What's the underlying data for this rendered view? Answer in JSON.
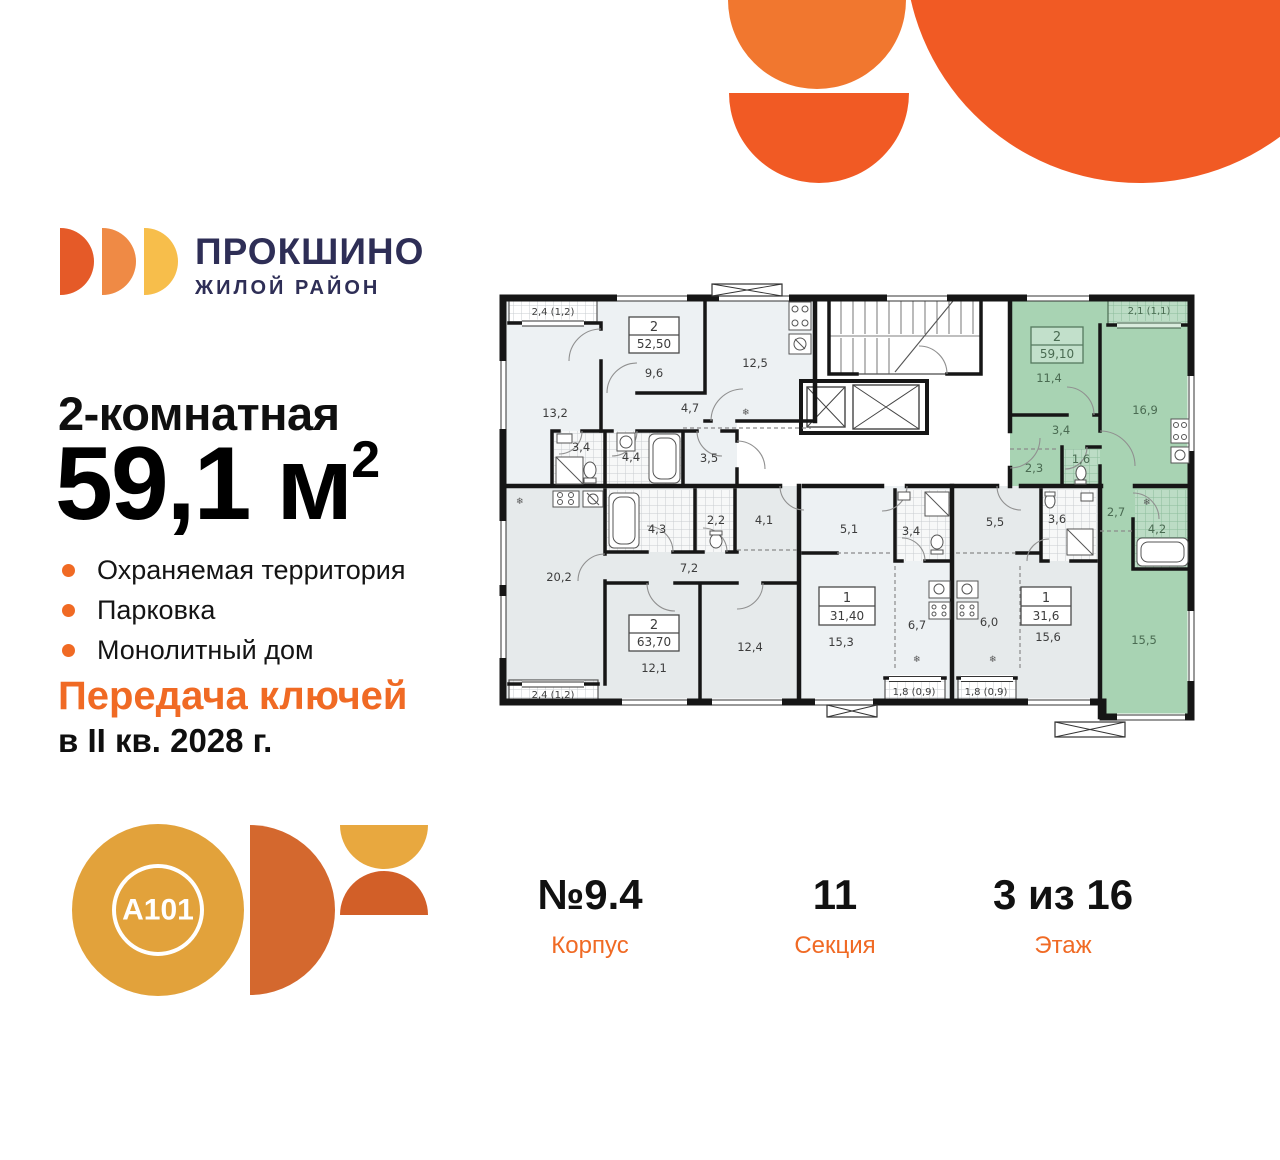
{
  "brand": {
    "name": "ПРОКШИНО",
    "subtitle": "ЖИЛОЙ РАЙОН"
  },
  "offer": {
    "type": "2-комнатная",
    "area_value": "59,1 м",
    "area_sup": "2",
    "features": [
      "Охраняемая территория",
      "Парковка",
      "Монолитный дом"
    ],
    "handover_title": "Передача ключей",
    "handover_date": "в II кв. 2028 г."
  },
  "developer": {
    "logo_text": "A101"
  },
  "meta": {
    "building": {
      "value": "№9.4",
      "label": "Корпус"
    },
    "section": {
      "value": "11",
      "label": "Секция"
    },
    "floor": {
      "value": "3 из 16",
      "label": "Этаж"
    }
  },
  "plan": {
    "a52": {
      "num": "2",
      "area": "52,50",
      "balcony": "2,4 (1,2)",
      "r1": "13,2",
      "r2": "9,6",
      "r3": "12,5",
      "r4": "4,7",
      "r5": "3,4",
      "r6": "4,4",
      "r7": "3,5"
    },
    "a59": {
      "num": "2",
      "area": "59,10",
      "balcony": "2,1 (1,1)",
      "r1": "11,4",
      "r2": "16,9",
      "r3": "3,4",
      "r4": "2,3",
      "r5": "1,6",
      "r6": "2,7",
      "r7": "4,2",
      "r8": "15,5"
    },
    "a63": {
      "num": "2",
      "area": "63,70",
      "balcony": "2,4 (1,2)",
      "r1": "20,2",
      "r2": "4,3",
      "r3": "2,2",
      "r4": "4,1",
      "r5": "7,2",
      "r6": "12,1",
      "r7": "12,4"
    },
    "b31": {
      "num": "1",
      "area": "31,40",
      "balcony": "1,8 (0,9)",
      "r1": "5,1",
      "r2": "3,4",
      "r3": "15,3",
      "r4": "6,7"
    },
    "c31": {
      "num": "1",
      "area": "31,6",
      "balcony": "1,8 (0,9)",
      "r1": "5,5",
      "r2": "3,6",
      "r3": "6,0",
      "r4": "15,6"
    }
  },
  "colors": {
    "accent_orange": "#F06A24",
    "decor_orange": "#F15A24",
    "decor_orange_light": "#F1772F",
    "brand_navy": "#2E2E56",
    "logo_disc1": "#E55A28",
    "logo_disc2": "#EF8A45",
    "logo_disc3": "#F7BE4B",
    "a101_yellow": "#E2A23B",
    "a101_orange": "#D4682E",
    "plan_highlight_green": "#A8D3B3",
    "plan_fill_light": "#EDF1F3",
    "plan_fill_gray": "#E6EAEB",
    "plan_green_text": "#4A6B52",
    "wall": "#161616"
  }
}
